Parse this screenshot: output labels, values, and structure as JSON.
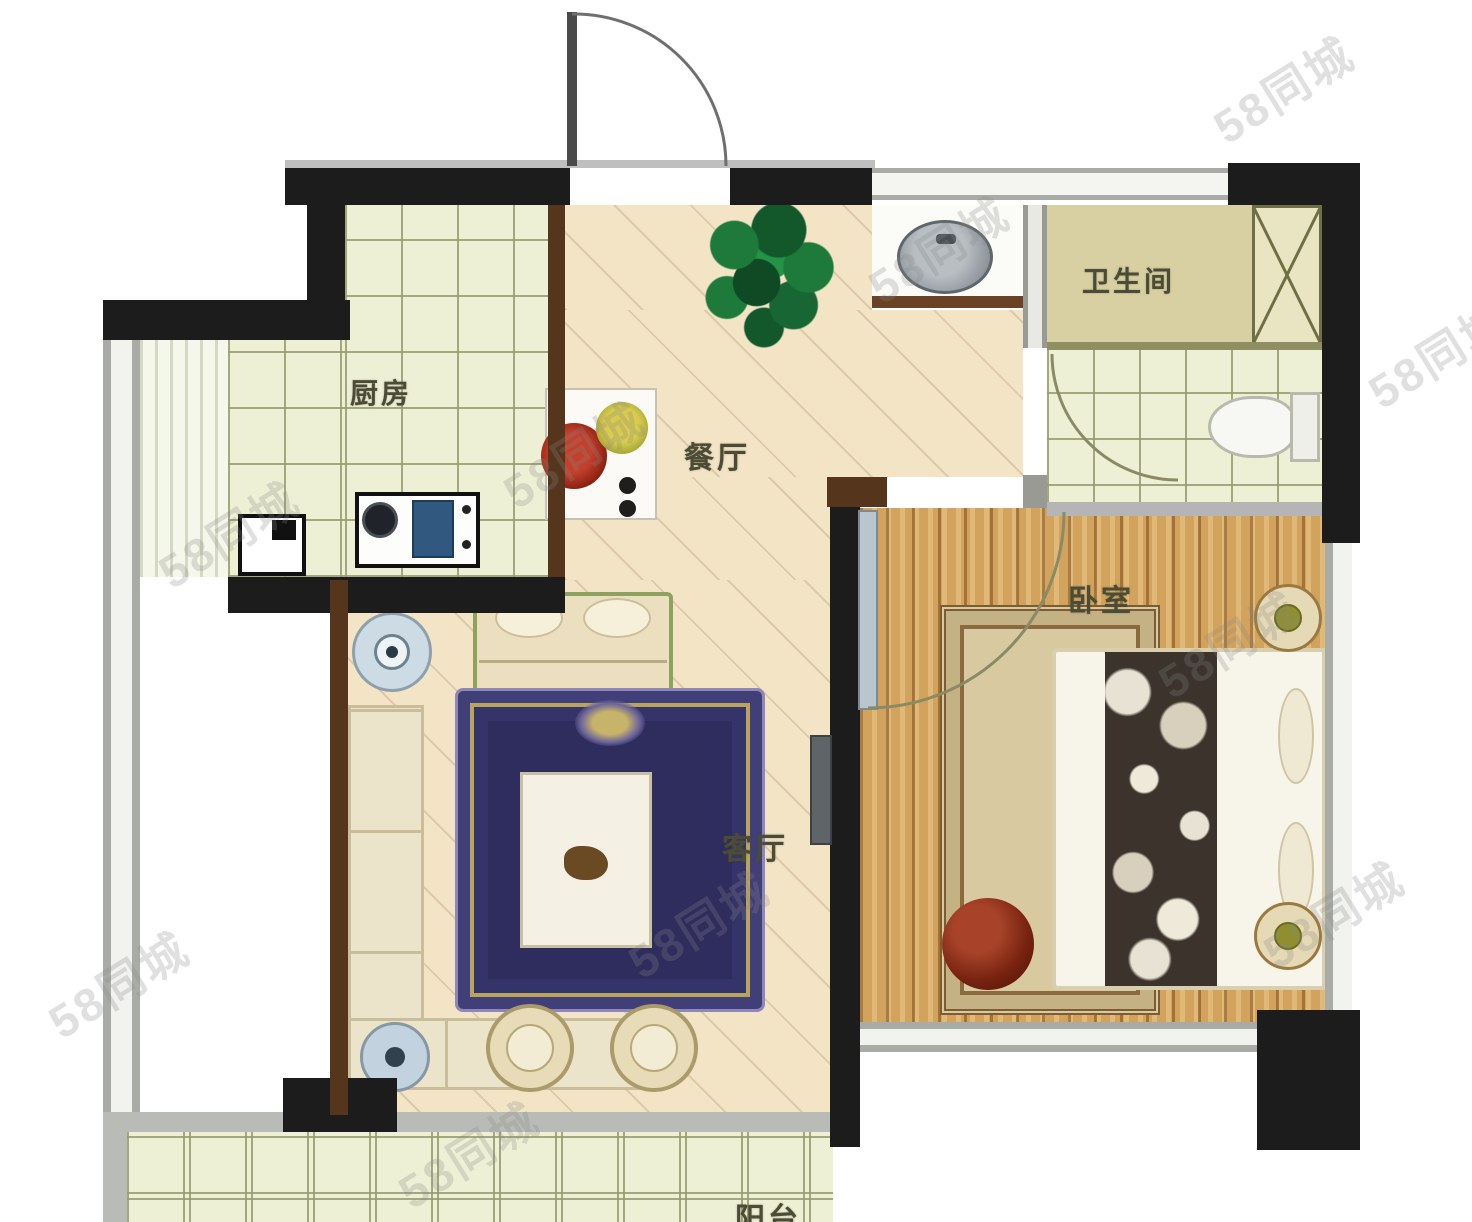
{
  "watermark": {
    "text": "58同城"
  },
  "rooms": {
    "kitchen": {
      "label": "厨房"
    },
    "dining": {
      "label": "餐厅"
    },
    "bathroom": {
      "label": "卫生间"
    },
    "bedroom": {
      "label": "卧室"
    },
    "living": {
      "label": "客厅"
    },
    "balcony": {
      "label": "阳台"
    }
  },
  "colors": {
    "wall": "#1c1c1c",
    "wood_wall": "#56351d",
    "tile_floor": "#eef0d6",
    "tile_grid": "#969b6e",
    "beige_floor": "#f3e4c6",
    "bedroom_wood": "#d2a35c",
    "bathroom_tan": "#d8d0a2",
    "rug_navy": "#2e2d5e",
    "rug_gold": "#b9a45e",
    "plant_green": "#1d7a3a",
    "sofa_cream": "#ece4ca",
    "stove_navy": "#31597f",
    "dish_red": "#a93020",
    "dish_yellow": "#c9b839",
    "window_gray": "#a9aca6"
  }
}
